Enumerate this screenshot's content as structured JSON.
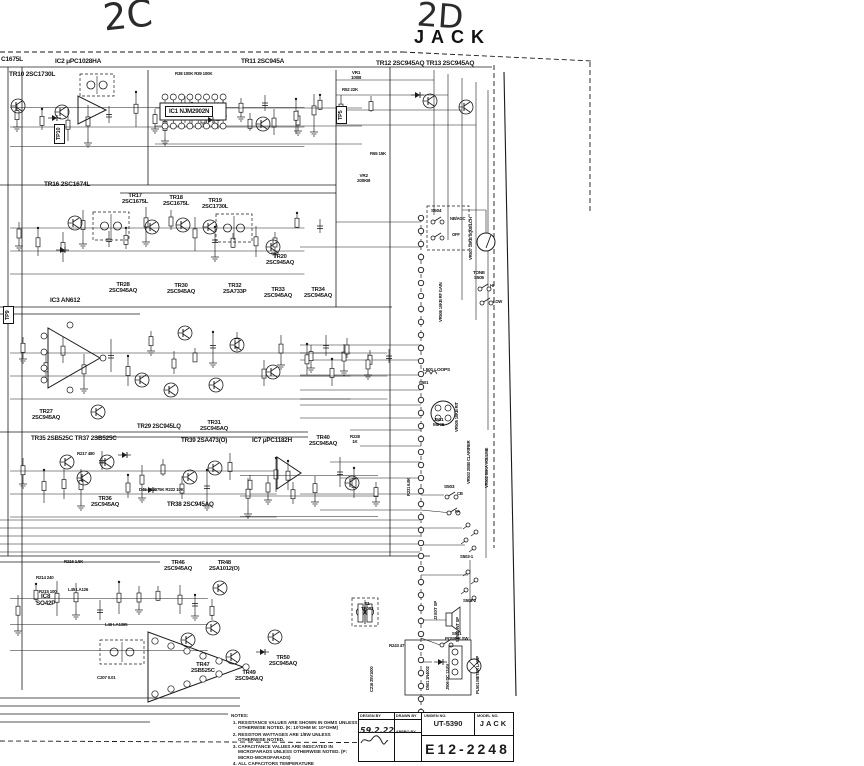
{
  "annotations": {
    "left": "2C",
    "right": "2D",
    "jack": "JACK"
  },
  "labels": [
    {
      "text": "C1675L",
      "x": 1,
      "y": 56,
      "s": 6.5
    },
    {
      "text": "IC2 μPC1028HA",
      "x": 55,
      "y": 58,
      "s": 6.5
    },
    {
      "text": "TR10 2SC1730L",
      "x": 9,
      "y": 71,
      "s": 6.5
    },
    {
      "text": "TR11 2SC945A",
      "x": 241,
      "y": 58,
      "s": 6.5
    },
    {
      "text": "TR12 2SC945AQ TR13 2SC945AQ",
      "x": 376,
      "y": 60,
      "s": 6.5
    },
    {
      "text": "IC1 NJM2902N",
      "x": 165,
      "y": 106,
      "s": 6.2,
      "box": true
    },
    {
      "text": "TR16 2SC1674L",
      "x": 44,
      "y": 181,
      "s": 6.5
    },
    {
      "text": "TR17\n2SC1675L",
      "x": 122,
      "y": 193,
      "s": 5.8,
      "c": true
    },
    {
      "text": "TR18\n2SC1675L",
      "x": 163,
      "y": 195,
      "s": 5.8,
      "c": true
    },
    {
      "text": "TR19\n2SC1730L",
      "x": 202,
      "y": 198,
      "s": 5.8,
      "c": true
    },
    {
      "text": "TR20\n2SC945AQ",
      "x": 266,
      "y": 254,
      "s": 5.8,
      "c": true
    },
    {
      "text": "TR28\n2SC945AQ",
      "x": 109,
      "y": 282,
      "s": 5.8,
      "c": true
    },
    {
      "text": "TR30\n2SC945AQ",
      "x": 167,
      "y": 283,
      "s": 5.8,
      "c": true
    },
    {
      "text": "TR32\n2SA733P",
      "x": 223,
      "y": 283,
      "s": 5.8,
      "c": true
    },
    {
      "text": "TR33\n2SC945AQ",
      "x": 264,
      "y": 287,
      "s": 5.8,
      "c": true
    },
    {
      "text": "TR34\n2SC945AQ",
      "x": 304,
      "y": 287,
      "s": 5.8,
      "c": true
    },
    {
      "text": "IC3 AN612",
      "x": 50,
      "y": 297,
      "s": 6.5
    },
    {
      "text": "TR27\n2SC945AQ",
      "x": 32,
      "y": 409,
      "s": 5.8,
      "c": true
    },
    {
      "text": "TR29 2SC945LQ",
      "x": 137,
      "y": 424,
      "s": 6
    },
    {
      "text": "TR31\n2SC945AQ",
      "x": 200,
      "y": 420,
      "s": 5.8,
      "c": true
    },
    {
      "text": "TR35 2SB525C TR37 2SB525C",
      "x": 31,
      "y": 436,
      "s": 6.3
    },
    {
      "text": "TR39 2SA473(O)",
      "x": 181,
      "y": 438,
      "s": 6.3
    },
    {
      "text": "IC7 μPC1182H",
      "x": 252,
      "y": 438,
      "s": 6.3
    },
    {
      "text": "TR36\n2SC945AQ",
      "x": 91,
      "y": 496,
      "s": 5.8,
      "c": true
    },
    {
      "text": "TR38 2SC945AQ",
      "x": 167,
      "y": 502,
      "s": 6.3
    },
    {
      "text": "TR40\n2SC945AQ",
      "x": 309,
      "y": 435,
      "s": 5.8,
      "c": true
    },
    {
      "text": "TR46\n2SC945AQ",
      "x": 164,
      "y": 560,
      "s": 5.8,
      "c": true
    },
    {
      "text": "TR48\n2SA1012(O)",
      "x": 209,
      "y": 560,
      "s": 5.8,
      "c": true
    },
    {
      "text": "IC8\nSO42P",
      "x": 36,
      "y": 594,
      "s": 6.3,
      "c": true
    },
    {
      "text": "TR47\n2SB525C",
      "x": 191,
      "y": 662,
      "s": 5.8,
      "c": true
    },
    {
      "text": "TR49\n2SC945AQ",
      "x": 235,
      "y": 670,
      "s": 5.8,
      "c": true
    },
    {
      "text": "TR50\n2SC945AQ",
      "x": 269,
      "y": 655,
      "s": 5.8,
      "c": true
    },
    {
      "text": "VR1\n100B",
      "x": 351,
      "y": 71,
      "s": 4.6,
      "c": true
    },
    {
      "text": "R52 22K",
      "x": 342,
      "y": 88,
      "s": 4.4
    },
    {
      "text": "R38 100K  R39 100K",
      "x": 175,
      "y": 72,
      "s": 4.4
    },
    {
      "text": "R65 15K",
      "x": 370,
      "y": 152,
      "s": 4.4
    },
    {
      "text": "VR2\n200KB",
      "x": 357,
      "y": 174,
      "s": 4.6,
      "c": true
    },
    {
      "text": "S504",
      "x": 431,
      "y": 209,
      "s": 4.8
    },
    {
      "text": "NB/AGC",
      "x": 450,
      "y": 217,
      "s": 4.2
    },
    {
      "text": "OFF",
      "x": 452,
      "y": 233,
      "s": 4.2
    },
    {
      "text": "TONE\nS505",
      "x": 473,
      "y": 271,
      "s": 4.6,
      "c": true
    },
    {
      "text": "HI",
      "x": 490,
      "y": 284,
      "s": 4.2
    },
    {
      "text": "LOW",
      "x": 493,
      "y": 300,
      "s": 4.2
    },
    {
      "text": "L501 LOOPS",
      "x": 423,
      "y": 368,
      "s": 4.8
    },
    {
      "text": "C501",
      "x": 419,
      "y": 381,
      "s": 4.2
    },
    {
      "text": "J501\nMIKE",
      "x": 433,
      "y": 418,
      "s": 4.8,
      "c": true
    },
    {
      "text": "S503",
      "x": 444,
      "y": 485,
      "s": 4.8
    },
    {
      "text": "CB",
      "x": 457,
      "y": 492,
      "s": 4.2
    },
    {
      "text": "PA",
      "x": 455,
      "y": 510,
      "s": 4.2
    },
    {
      "text": "S503-1",
      "x": 460,
      "y": 555,
      "s": 4.4
    },
    {
      "text": "S502-2",
      "x": 463,
      "y": 599,
      "s": 4.4
    },
    {
      "text": "T1\nTF083",
      "x": 361,
      "y": 602,
      "s": 4.6,
      "c": true
    },
    {
      "text": "S501\nPOWER SW",
      "x": 445,
      "y": 632,
      "s": 4.4,
      "c": true
    },
    {
      "text": "R243 47",
      "x": 389,
      "y": 644,
      "s": 4.4
    },
    {
      "text": "R217 480",
      "x": 77,
      "y": 452,
      "s": 4.4
    },
    {
      "text": "D45 1S2075K  R222 10K",
      "x": 139,
      "y": 488,
      "s": 4.4
    },
    {
      "text": "R216 1.5K",
      "x": 64,
      "y": 560,
      "s": 4.4
    },
    {
      "text": "R214 240",
      "x": 36,
      "y": 576,
      "s": 4.4
    },
    {
      "text": "R215 100",
      "x": 39,
      "y": 590,
      "s": 4.4
    },
    {
      "text": "L45 LA126",
      "x": 68,
      "y": 588,
      "s": 4.4
    },
    {
      "text": "L46 LA1365",
      "x": 105,
      "y": 623,
      "s": 4.4
    },
    {
      "text": "C207 0.01",
      "x": 97,
      "y": 676,
      "s": 4.4
    },
    {
      "text": "R228\n1K",
      "x": 350,
      "y": 435,
      "s": 4.4,
      "c": true
    },
    {
      "text": "TP9",
      "x": 3,
      "y": 324,
      "s": 5.5,
      "v": true,
      "box": true
    },
    {
      "text": "TP10",
      "x": 54,
      "y": 144,
      "s": 5.5,
      "v": true,
      "box": true
    },
    {
      "text": "TP5",
      "x": 336,
      "y": 124,
      "s": 5.5,
      "v": true,
      "box": true
    },
    {
      "text": "VR507 10KB SQUELCH",
      "x": 469,
      "y": 260,
      "s": 4.2,
      "v": true
    },
    {
      "text": "VR506 10KB RF GAIN",
      "x": 439,
      "y": 322,
      "s": 4.2,
      "v": true
    },
    {
      "text": "VR505 10KB RIT",
      "x": 455,
      "y": 432,
      "s": 4.2,
      "v": true
    },
    {
      "text": "VR503 200B CLARIFIER",
      "x": 467,
      "y": 484,
      "s": 4.2,
      "v": true
    },
    {
      "text": "VR502 50KA VOLUME",
      "x": 485,
      "y": 488,
      "s": 4.2,
      "v": true
    },
    {
      "text": "R231 6.8K",
      "x": 407,
      "y": 496,
      "s": 4.2,
      "v": true
    },
    {
      "text": "J2 EXT SP",
      "x": 434,
      "y": 620,
      "s": 4.2,
      "v": true
    },
    {
      "text": "SP501 INT SP",
      "x": 456,
      "y": 642,
      "s": 4.2,
      "v": true
    },
    {
      "text": "C216 25V1000",
      "x": 370,
      "y": 692,
      "s": 4.2,
      "v": true
    },
    {
      "text": "D501 1N4002",
      "x": 426,
      "y": 690,
      "s": 4.2,
      "v": true
    },
    {
      "text": "J506 DC 13.8V",
      "x": 446,
      "y": 690,
      "s": 4.2,
      "v": true
    },
    {
      "text": "PL501 METER LAMP",
      "x": 476,
      "y": 694,
      "s": 4.2,
      "v": true
    }
  ],
  "notes": {
    "title": "NOTES:",
    "items": [
      "RESISTANCE VALUES ARE SHOWN IN OHMS UNLESS OTHERWISE NOTED. (K: 10³OHM  M: 10⁶OHM)",
      "RESISTOR WATTAGES ARE 1/8W UNLESS OTHERWISE NOTED.",
      "CAPACITANCE VALUES ARE INDICATED IN MICROFARADS UNLESS OTHERWISE NOTED. (P: MICRO-MICROFARADS)",
      "ALL CAPACITORS TEMPERATURE CHARACTERISTICS ARE SL (LESS THAN 1000PF) OR YF (MORE THAN 1000PF) UNLESS OTHERWISE NOTED."
    ]
  },
  "title_block": {
    "design_by_label": "DESIGN BY",
    "drawn_by_label": "DRAWN BY",
    "appro_by_label": "APPRO BY",
    "design_date": "59.2.22",
    "order_no_label": "UNIDEN NO.",
    "order_no": "UT-5390",
    "model_no_label": "MODEL NO.",
    "model_no": "JACK",
    "drawing_no": "E12-2248"
  },
  "ink_color": "#1b1b1b"
}
